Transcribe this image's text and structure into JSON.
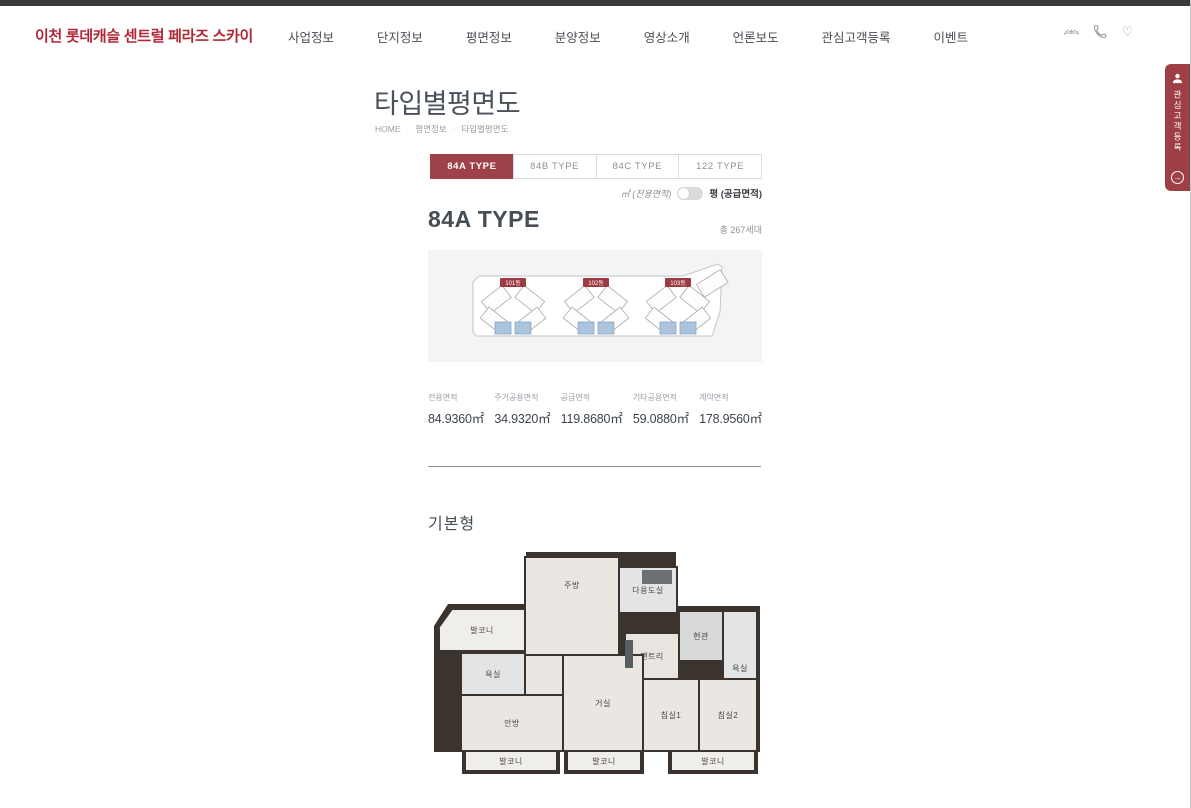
{
  "colors": {
    "accent_red": "#9e4148",
    "logo_red": "#b02836",
    "unit_blue": "#aac4dd",
    "top_bar": "#3a3a3c"
  },
  "header": {
    "logo": "이천 롯데캐슬 센트럴 페라즈 스카이",
    "nav": [
      "사업정보",
      "단지정보",
      "평면정보",
      "분양정보",
      "영상소개",
      "언론보도",
      "관심고객등록",
      "이벤트"
    ],
    "icons": [
      "wings-icon",
      "phone-icon",
      "heart-icon"
    ],
    "heart_glyph": "♡"
  },
  "side_tab": {
    "label": "관심고객등록",
    "arrow_glyph": "→"
  },
  "content": {
    "page_title": "타입별평면도",
    "breadcrumb": {
      "home": "HOME",
      "level1": "평면정보",
      "level2": "타입별평면도",
      "separator": "·"
    },
    "type_tabs": [
      {
        "label": "84A TYPE",
        "active": true
      },
      {
        "label": "84B TYPE",
        "active": false
      },
      {
        "label": "84C TYPE",
        "active": false
      },
      {
        "label": "122 TYPE",
        "active": false
      }
    ],
    "unit_toggle": {
      "left_label": "㎡ (전용면적)",
      "right_label": "평 (공급면적)"
    },
    "type_heading": "84A TYPE",
    "total_households": "총 267세대",
    "site_map": {
      "building_labels": [
        "101동",
        "102동",
        "103동"
      ]
    },
    "area_table": [
      {
        "label": "전용면적",
        "value": "84.9360㎡"
      },
      {
        "label": "주거공용면적",
        "value": "34.9320㎡"
      },
      {
        "label": "공급면적",
        "value": "119.8680㎡"
      },
      {
        "label": "기타공용면적",
        "value": "59.0880㎡"
      },
      {
        "label": "계약면적",
        "value": "178.9560㎡"
      }
    ],
    "plan_section": {
      "heading": "기본형",
      "rooms": {
        "balcony_tl": "발코니",
        "bath_left": "욕실",
        "kitchen": "주방",
        "utility": "다용도실",
        "pantry": "팬트리",
        "entrance": "현관",
        "bath_right": "욕실",
        "master": "안방",
        "living": "거실",
        "bed1": "침실1",
        "bed2": "침실2",
        "balcony_b1": "발코니",
        "balcony_b2": "발코니",
        "balcony_b3": "발코니"
      }
    }
  }
}
